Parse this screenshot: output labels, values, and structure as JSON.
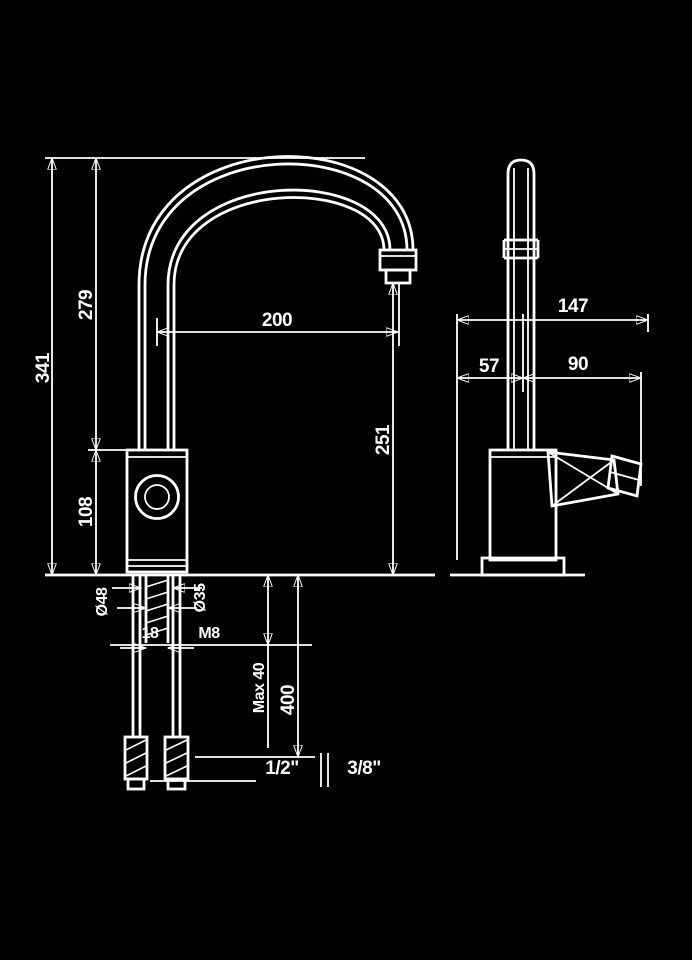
{
  "drawing": {
    "title": "kitchen-faucet-dimension-drawing",
    "colors": {
      "background": "#000000",
      "line": "#ffffff"
    },
    "front_view": {
      "total_height": "341",
      "upper_height": "279",
      "body_height": "108",
      "spout_reach": "200",
      "spout_clearance": "251",
      "base_diameter": "Ø48",
      "shank_diameter": "Ø35",
      "shank_length": "18",
      "stud_thread": "M8",
      "max_counter_thickness": "Max 40",
      "hose_length": "400",
      "connection_left": "1/2\"",
      "connection_right": "3/8\""
    },
    "side_view": {
      "total_depth": "147",
      "front_offset": "57",
      "rear_offset": "90"
    }
  }
}
